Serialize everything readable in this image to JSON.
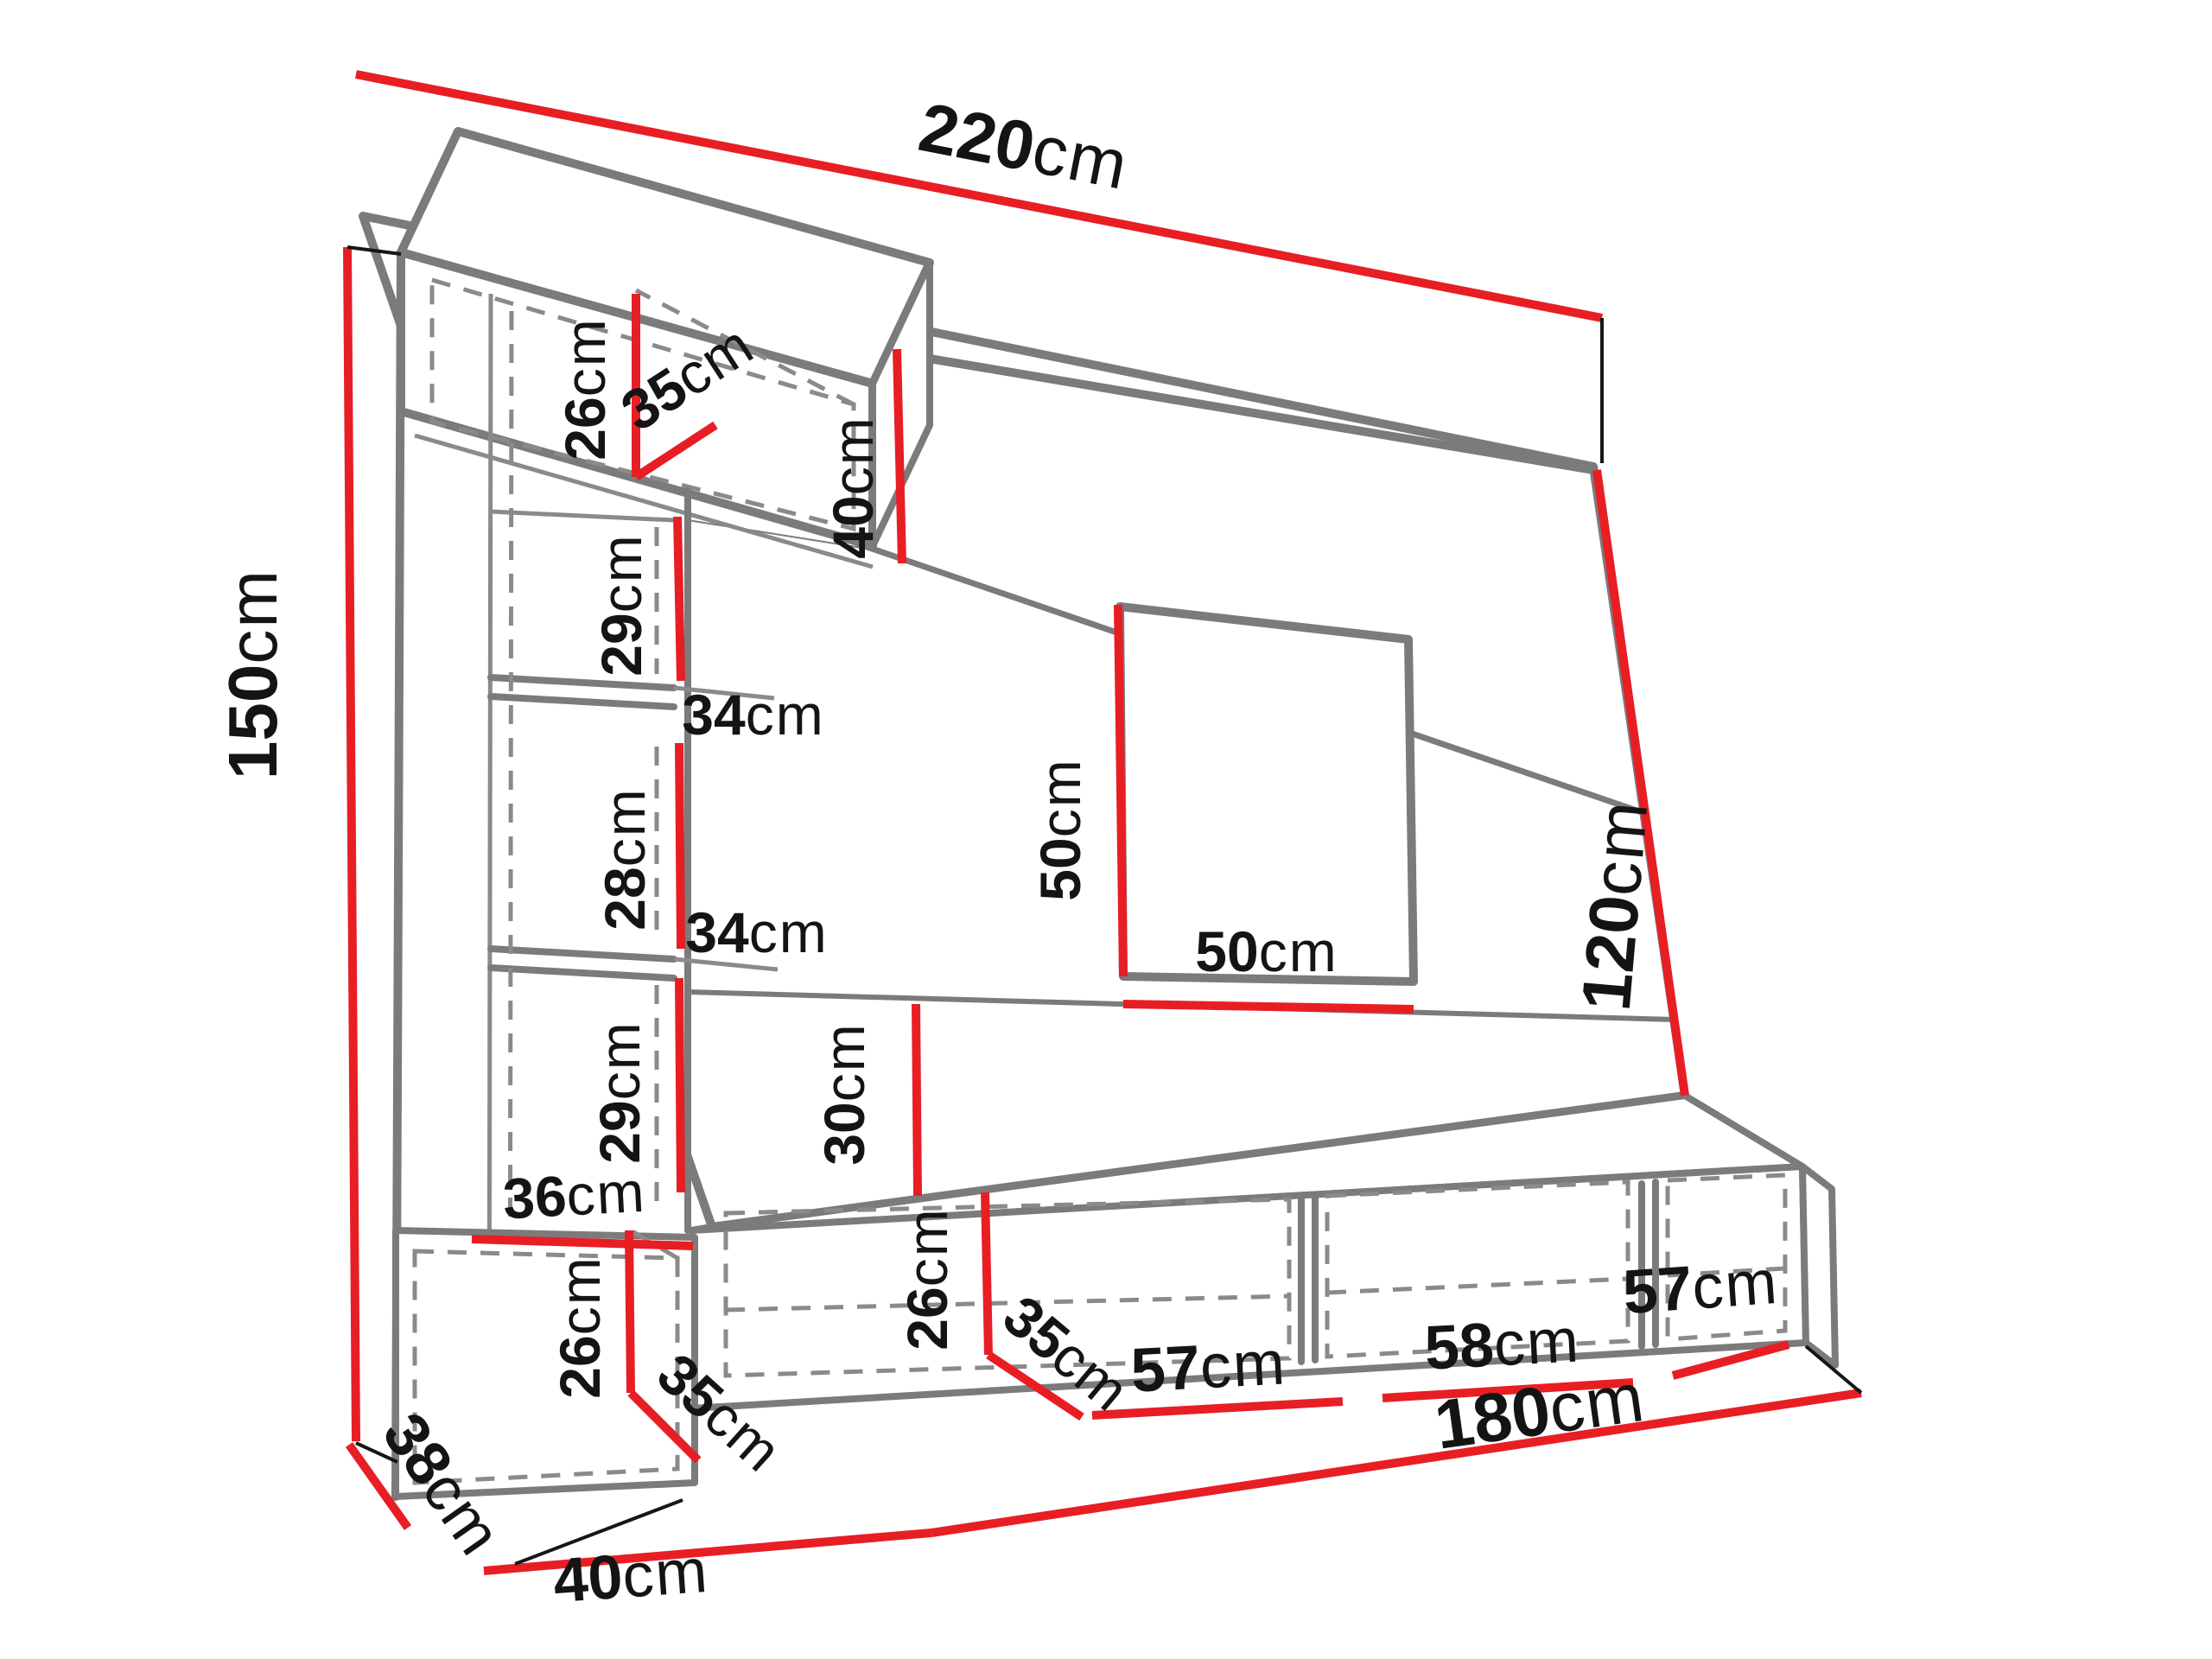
{
  "diagram": {
    "type": "furniture-dimension-drawing",
    "subject": "wall-unit entertainment center, perspective line drawing with red dimension lines",
    "colors": {
      "background": "#ffffff",
      "dimension_line": "#e81e25",
      "structure_line": "#7b7b7b",
      "label_text": "#141414"
    }
  },
  "dimensions": {
    "total_width": {
      "value": "220",
      "unit": "cm"
    },
    "total_height": {
      "value": "150",
      "unit": "cm"
    },
    "top_cabinet_height": {
      "value": "26",
      "unit": "cm"
    },
    "top_cabinet_depth": {
      "value": "35",
      "unit": "cm"
    },
    "top_panel_height": {
      "value": "40",
      "unit": "cm"
    },
    "shelf_gap_upper": {
      "value": "29",
      "unit": "cm"
    },
    "shelf_width_upper": {
      "value": "34",
      "unit": "cm"
    },
    "shelf_gap_middle": {
      "value": "28",
      "unit": "cm"
    },
    "shelf_width_lower": {
      "value": "34",
      "unit": "cm"
    },
    "shelf_gap_lower": {
      "value": "29",
      "unit": "cm"
    },
    "bottom_cabinet_width": {
      "value": "36",
      "unit": "cm"
    },
    "bottom_cabinet_height": {
      "value": "26",
      "unit": "cm"
    },
    "bottom_cabinet_depth": {
      "value": "35",
      "unit": "cm"
    },
    "tv_niche_height": {
      "value": "50",
      "unit": "cm"
    },
    "tv_niche_width": {
      "value": "50",
      "unit": "cm"
    },
    "right_panel_height": {
      "value": "120",
      "unit": "cm"
    },
    "bottom_panel_height": {
      "value": "30",
      "unit": "cm"
    },
    "bench_compartment_height": {
      "value": "26",
      "unit": "cm"
    },
    "bench_compartment_depth": {
      "value": "35",
      "unit": "cm"
    },
    "bench_compartment1_width": {
      "value": "57",
      "unit": "cm"
    },
    "bench_compartment2_width": {
      "value": "58",
      "unit": "cm"
    },
    "bench_compartment3_width": {
      "value": "57",
      "unit": "cm"
    },
    "bench_width": {
      "value": "180",
      "unit": "cm"
    },
    "base_width": {
      "value": "40",
      "unit": "cm"
    },
    "base_depth": {
      "value": "38",
      "unit": "cm"
    }
  }
}
